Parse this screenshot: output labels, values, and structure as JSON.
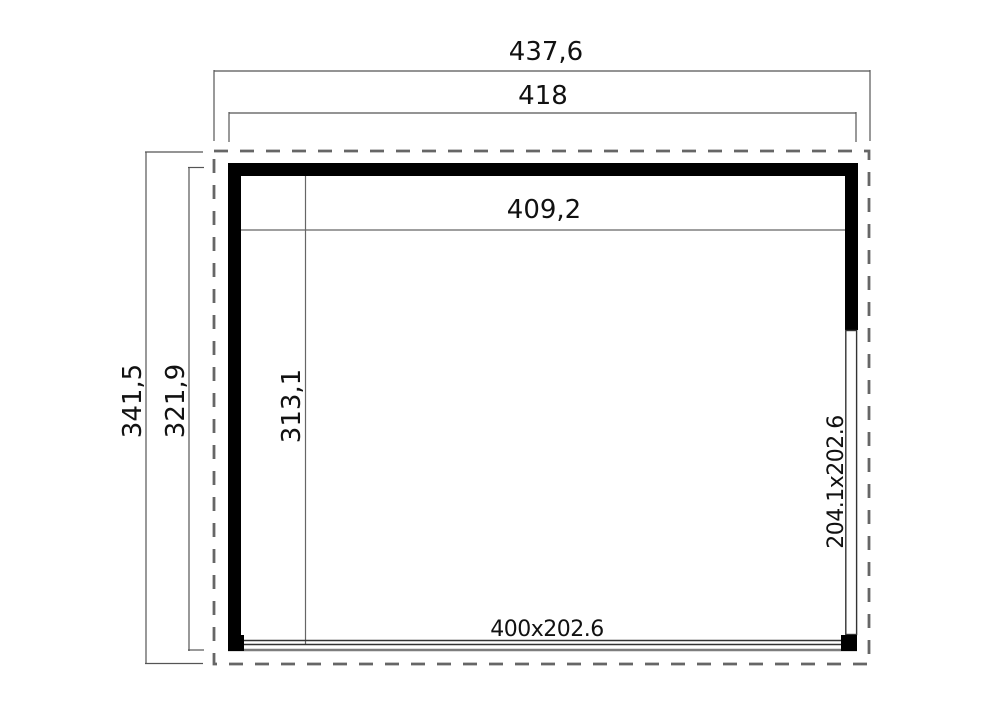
{
  "drawing": {
    "type": "floor-plan",
    "dimensions": {
      "outer_width": "437,6",
      "frame_width": "418",
      "interior_width": "409,2",
      "outer_depth": "341,5",
      "frame_depth": "321,9",
      "interior_depth": "313,1",
      "front_opening_size": "400x202.6",
      "side_opening_size": "204.1x202.6"
    },
    "colors": {
      "wall": "#000000",
      "dimension_line": "#555555",
      "roof_outline_dash": "#666666",
      "sill": "#7d7d7d",
      "text": "#111111",
      "background": "#ffffff"
    }
  }
}
